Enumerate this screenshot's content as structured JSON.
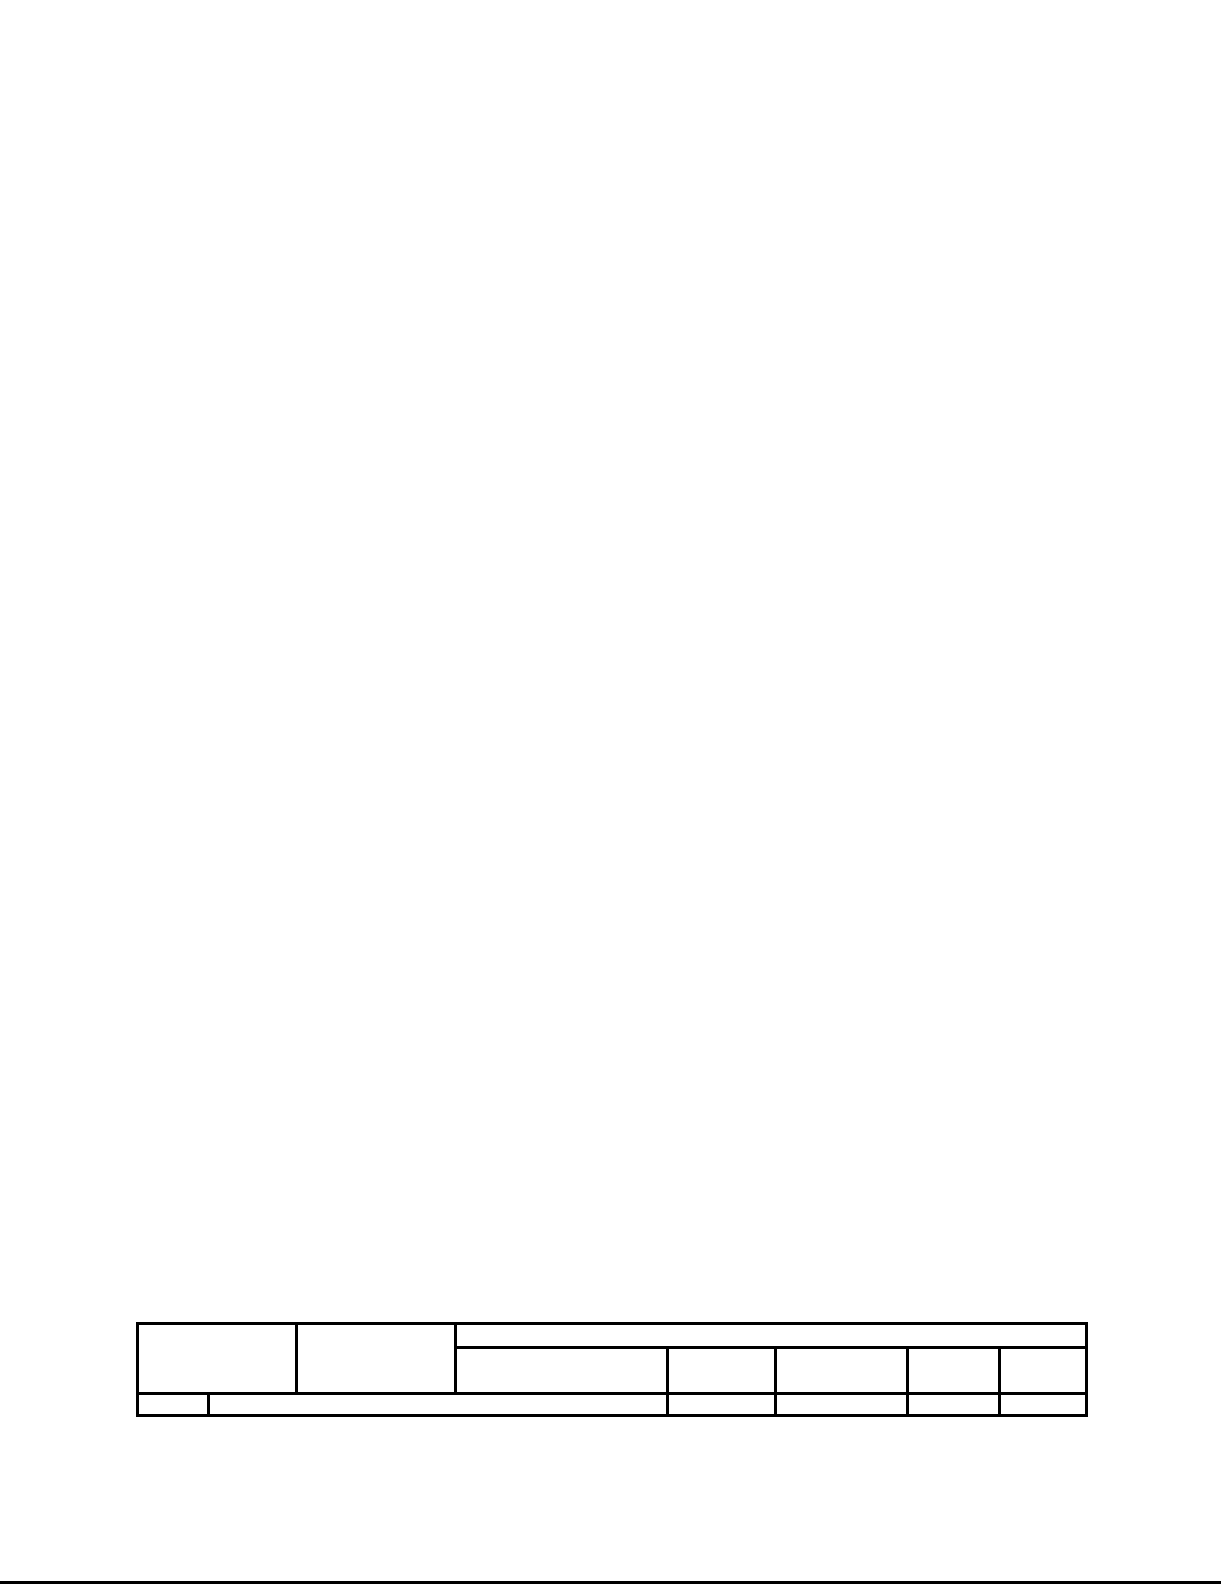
{
  "page": {
    "background": "#ffffff"
  },
  "colors": {
    "table_line": "#000000",
    "bottom_rule": "#000000"
  },
  "table": {
    "header_col_1": "",
    "header_col_2": "",
    "group_header": "",
    "group_subheaders": [
      "",
      "",
      "",
      "",
      ""
    ],
    "data_row": [
      "",
      "",
      "",
      "",
      "",
      ""
    ]
  }
}
